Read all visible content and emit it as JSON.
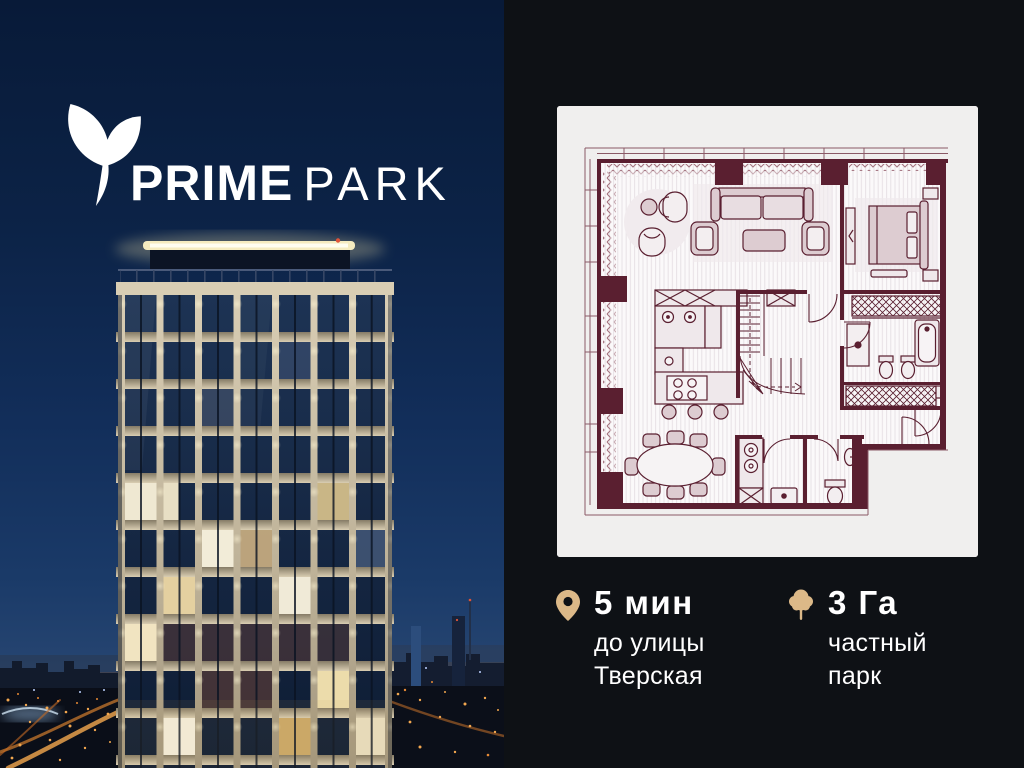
{
  "brand": {
    "icon": "sprout-leaf-icon",
    "name_primary": "PRIME",
    "name_secondary": "PARK"
  },
  "media": {
    "left_panel": "night-photo-prime-park-tower",
    "right_panel_card": "apartment-floor-plan-drawing"
  },
  "stats": [
    {
      "icon": "location-pin-icon",
      "value": "5 мин",
      "label": "до улицы Тверская"
    },
    {
      "icon": "tree-icon",
      "value": "3 Га",
      "label": "частный парк"
    }
  ],
  "colors": {
    "sky_navy": "#0e2850",
    "panel_background": "#0e1115",
    "card_background": "#f0efee",
    "plan_walls": "#5a1f30",
    "plan_furniture": "#ddccd1",
    "accent_gold": "#dcb988",
    "text": "#ffffff"
  }
}
